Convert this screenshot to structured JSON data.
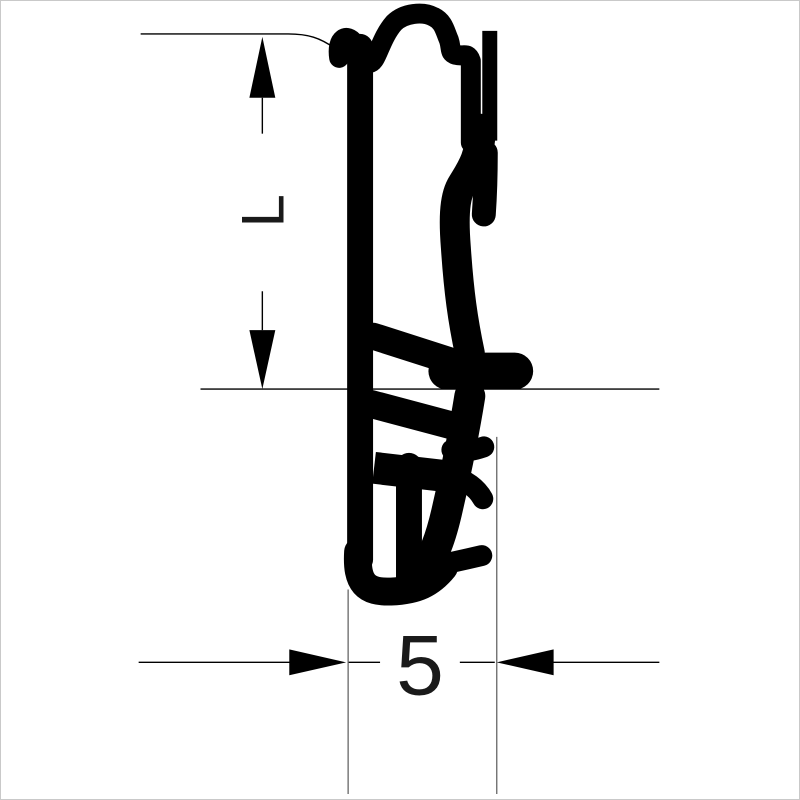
{
  "drawing": {
    "title": "seal-profile-cross-section",
    "background_color": "#ffffff",
    "profile_color": "#000000",
    "thin_line_color": "#000000",
    "extension_line_color": "#666666",
    "dimensions": {
      "vertical": {
        "label": "L"
      },
      "horizontal": {
        "label": "5"
      }
    }
  }
}
